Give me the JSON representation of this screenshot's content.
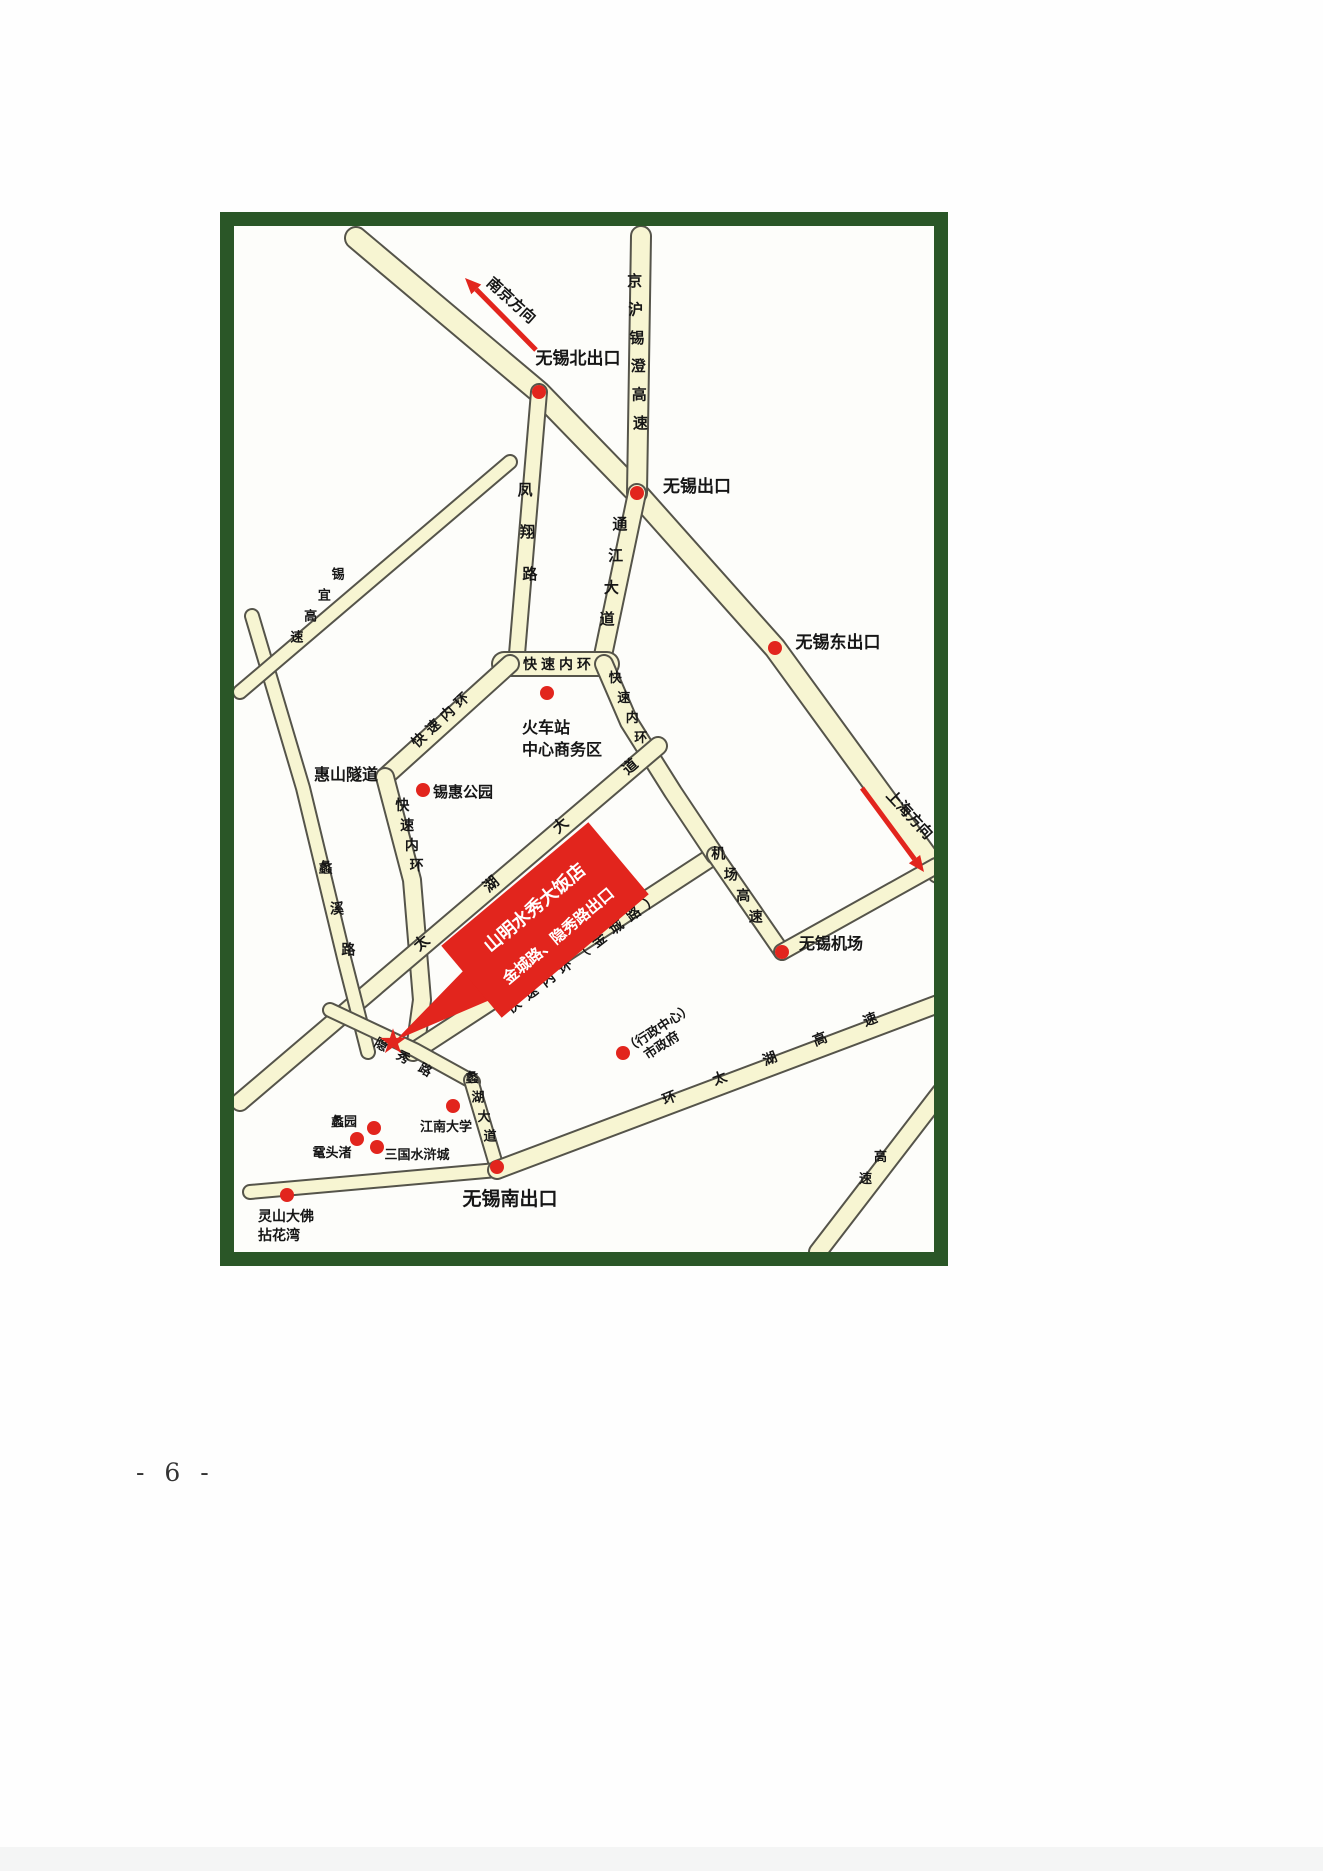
{
  "page": {
    "number_label": "- 6 -"
  },
  "map": {
    "frame_color": "#2a5627",
    "map_bg": "#fdfdfa",
    "road_fill": "#f7f5d2",
    "road_casing": "#55544a",
    "accent_red": "#e2251d",
    "text_color": "#161616",
    "roads": [
      {
        "id": "huning-expressway",
        "points": [
          [
            356,
            238
          ],
          [
            539,
            392
          ],
          [
            637,
            493
          ],
          [
            775,
            648
          ],
          [
            938,
            872
          ]
        ],
        "width": 20
      },
      {
        "id": "jinghu-xicheng-expressway",
        "points": [
          [
            641,
            236
          ],
          [
            637,
            493
          ]
        ],
        "width": 18,
        "label": {
          "text": "京沪锡澄高速",
          "mode": "stacked",
          "from": [
            634,
            272
          ],
          "to": [
            641,
            442
          ],
          "size": 15
        }
      },
      {
        "id": "tongjiang-avenue",
        "points": [
          [
            637,
            493
          ],
          [
            601,
            665
          ]
        ],
        "width": 16,
        "label": {
          "text": "通江大道",
          "mode": "stacked",
          "from": [
            622,
            513
          ],
          "to": [
            605,
            640
          ],
          "size": 15
        }
      },
      {
        "id": "fengxiang-road",
        "points": [
          [
            539,
            392
          ],
          [
            516,
            666
          ]
        ],
        "width": 14,
        "label": {
          "text": "凤翔路",
          "mode": "stacked",
          "from": [
            524,
            474
          ],
          "to": [
            531,
            600
          ],
          "size": 15
        }
      },
      {
        "id": "inner-ring-top",
        "points": [
          [
            504,
            664
          ],
          [
            607,
            664
          ]
        ],
        "width": 22,
        "label": {
          "text": "快速内环",
          "mode": "along",
          "from": [
            521,
            669
          ],
          "to": [
            593,
            669
          ],
          "size": 14
        }
      },
      {
        "id": "inner-ring-northwest",
        "points": [
          [
            510,
            664
          ],
          [
            385,
            777
          ]
        ],
        "width": 16,
        "label": {
          "text": "快速内环",
          "mode": "along",
          "from": [
            415,
            750
          ],
          "to": [
            472,
            697
          ],
          "size": 14
        }
      },
      {
        "id": "inner-ring-west",
        "points": [
          [
            385,
            777
          ],
          [
            412,
            880
          ],
          [
            422,
            1000
          ],
          [
            415,
            1050
          ]
        ],
        "width": 16,
        "label": {
          "text": "快速内环",
          "mode": "stacked",
          "from": [
            400,
            800
          ],
          "to": [
            419,
            880
          ],
          "size": 14
        }
      },
      {
        "id": "inner-ring-south-jincheng-road",
        "points": [
          [
            413,
            1052
          ],
          [
            715,
            855
          ]
        ],
        "width": 16,
        "label": {
          "text": "快速内环（金城路）",
          "mode": "along",
          "from": [
            508,
            1016
          ],
          "to": [
            662,
            898
          ],
          "size": 14
        }
      },
      {
        "id": "inner-ring-east",
        "points": [
          [
            604,
            664
          ],
          [
            629,
            722
          ],
          [
            673,
            792
          ],
          [
            715,
            855
          ]
        ],
        "width": 16,
        "label": {
          "text": "快速内环",
          "mode": "stacked",
          "from": [
            611,
            672
          ],
          "to": [
            645,
            752
          ],
          "size": 13
        }
      },
      {
        "id": "airport-expressway",
        "points": [
          [
            715,
            855
          ],
          [
            782,
            952
          ]
        ],
        "width": 14,
        "label": {
          "text": "机场高速",
          "mode": "stacked",
          "from": [
            712,
            848
          ],
          "to": [
            762,
            932
          ],
          "size": 14
        }
      },
      {
        "id": "airport-link-road",
        "points": [
          [
            782,
            952
          ],
          [
            936,
            866
          ]
        ],
        "width": 14
      },
      {
        "id": "taihu-avenue",
        "points": [
          [
            658,
            746
          ],
          [
            240,
            1102
          ]
        ],
        "width": 16,
        "label": {
          "text": "太湖大道",
          "mode": "along",
          "from": [
            390,
            976
          ],
          "to": [
            668,
            741
          ],
          "size": 15
        }
      },
      {
        "id": "lixi-road",
        "points": [
          [
            252,
            616
          ],
          [
            303,
            788
          ],
          [
            345,
            962
          ],
          [
            368,
            1052
          ]
        ],
        "width": 12,
        "label": {
          "text": "蠡溪路",
          "mode": "stacked",
          "from": [
            320,
            852
          ],
          "to": [
            354,
            975
          ],
          "size": 14
        }
      },
      {
        "id": "xiyi-expressway",
        "points": [
          [
            510,
            462
          ],
          [
            240,
            692
          ]
        ],
        "width": 12,
        "label": {
          "text": "锡宜高速",
          "mode": "stacked",
          "from": [
            345,
            568
          ],
          "to": [
            290,
            652
          ],
          "size": 13
        }
      },
      {
        "id": "yinxiu-road",
        "points": [
          [
            330,
            1010
          ],
          [
            415,
            1050
          ],
          [
            473,
            1082
          ]
        ],
        "width": 12,
        "label": {
          "text": "隐秀路",
          "mode": "along",
          "from": [
            368,
            1042
          ],
          "to": [
            434,
            1080
          ],
          "size": 13
        }
      },
      {
        "id": "lihu-avenue",
        "points": [
          [
            471,
            1080
          ],
          [
            497,
            1168
          ]
        ],
        "width": 12,
        "label": {
          "text": "蠡湖大道",
          "mode": "stacked",
          "from": [
            469,
            1072
          ],
          "to": [
            493,
            1150
          ],
          "size": 13
        }
      },
      {
        "id": "southwest-lakeside-road",
        "points": [
          [
            250,
            1192
          ],
          [
            497,
            1170
          ]
        ],
        "width": 12
      },
      {
        "id": "ring-taihu-expressway",
        "points": [
          [
            497,
            1170
          ],
          [
            938,
            1004
          ]
        ],
        "width": 16,
        "label": {
          "text": "环太湖高速",
          "mode": "along",
          "from": [
            646,
            1112
          ],
          "to": [
            897,
            1014
          ],
          "size": 14
        }
      },
      {
        "id": "corner-expressway",
        "points": [
          [
            941,
            1092
          ],
          [
            818,
            1252
          ]
        ],
        "width": 16,
        "label": {
          "text": "高速",
          "mode": "stacked",
          "from": [
            888,
            1150
          ],
          "to": [
            858,
            1194
          ],
          "size": 13
        }
      }
    ],
    "dots": [
      {
        "id": "wuxi-north-exit-dot",
        "x": 539,
        "y": 392
      },
      {
        "id": "wuxi-exit-dot",
        "x": 637,
        "y": 493
      },
      {
        "id": "wuxi-east-exit-dot",
        "x": 775,
        "y": 648
      },
      {
        "id": "railway-station-dot",
        "x": 547,
        "y": 693
      },
      {
        "id": "xihui-park-dot",
        "x": 423,
        "y": 790
      },
      {
        "id": "wuxi-airport-dot",
        "x": 782,
        "y": 952
      },
      {
        "id": "city-government-dot",
        "x": 623,
        "y": 1053
      },
      {
        "id": "wuxi-south-exit-dot",
        "x": 497,
        "y": 1167
      },
      {
        "id": "jiangnan-university-dot",
        "x": 453,
        "y": 1106
      },
      {
        "id": "liyuan-garden-dot",
        "x": 374,
        "y": 1128
      },
      {
        "id": "yuantouzhu-dot",
        "x": 357,
        "y": 1139
      },
      {
        "id": "three-kingdoms-city-dot",
        "x": 377,
        "y": 1147
      },
      {
        "id": "lingshan-buddha-dot",
        "x": 287,
        "y": 1195
      }
    ],
    "labels": [
      {
        "id": "wuxi-north-exit-label",
        "text": "无锡北出口",
        "x": 578,
        "y": 364,
        "size": 17,
        "bold": true
      },
      {
        "id": "wuxi-exit-label",
        "text": "无锡出口",
        "x": 697,
        "y": 492,
        "size": 17,
        "bold": true
      },
      {
        "id": "wuxi-east-exit-label",
        "text": "无锡东出口",
        "x": 838,
        "y": 648,
        "size": 17,
        "bold": true
      },
      {
        "id": "wuxi-airport-label",
        "text": "无锡机场",
        "x": 831,
        "y": 949,
        "size": 16,
        "bold": true
      },
      {
        "id": "wuxi-south-exit-label",
        "text": "无锡南出口",
        "x": 510,
        "y": 1205,
        "size": 19,
        "bold": true
      },
      {
        "id": "railway-station-label-line1",
        "text": "火车站",
        "x": 522,
        "y": 733,
        "size": 16,
        "bold": true,
        "anchor": "start"
      },
      {
        "id": "railway-station-label-line2",
        "text": "中心商务区",
        "x": 522,
        "y": 755,
        "size": 16,
        "bold": true,
        "anchor": "start"
      },
      {
        "id": "huishan-tunnel-label",
        "text": "惠山隧道",
        "x": 346,
        "y": 780,
        "size": 16,
        "bold": true
      },
      {
        "id": "xihui-park-label",
        "text": "锡惠公园",
        "x": 463,
        "y": 797,
        "size": 15,
        "bold": true
      },
      {
        "id": "jiangnan-university-label",
        "text": "江南大学",
        "x": 446,
        "y": 1131,
        "size": 13,
        "bold": true
      },
      {
        "id": "liyuan-garden-label",
        "text": "蠡园",
        "x": 344,
        "y": 1126,
        "size": 13,
        "bold": true
      },
      {
        "id": "yuantouzhu-label",
        "text": "鼋头渚",
        "x": 332,
        "y": 1157,
        "size": 13,
        "bold": true
      },
      {
        "id": "three-kingdoms-city-label",
        "text": "三国水浒城",
        "x": 417,
        "y": 1159,
        "size": 13,
        "bold": true
      },
      {
        "id": "lingshan-buddha-label-line1",
        "text": "灵山大佛",
        "x": 258,
        "y": 1221,
        "size": 14,
        "bold": true,
        "anchor": "start"
      },
      {
        "id": "lingshan-buddha-label-line2",
        "text": "拈花湾",
        "x": 258,
        "y": 1240,
        "size": 14,
        "bold": true,
        "anchor": "start"
      },
      {
        "id": "admin-center-label",
        "text": "（行政中心）",
        "x": 661,
        "y": 1032,
        "size": 13,
        "bold": true,
        "rotate": -33
      },
      {
        "id": "city-government-label",
        "text": "市政府",
        "x": 664,
        "y": 1049,
        "size": 13,
        "bold": true,
        "rotate": -33
      },
      {
        "id": "nanjing-direction-label",
        "text": "南京方向",
        "x": 508,
        "y": 304,
        "size": 15,
        "bold": true,
        "rotate": 42
      },
      {
        "id": "shanghai-direction-label",
        "text": "上海方向",
        "x": 906,
        "y": 818,
        "size": 15,
        "bold": true,
        "rotate": 47
      }
    ],
    "arrows": [
      {
        "id": "nanjing-direction-arrow",
        "from": [
          536,
          350
        ],
        "to": [
          465,
          278
        ]
      },
      {
        "id": "shanghai-direction-arrow",
        "from": [
          862,
          788
        ],
        "to": [
          924,
          872
        ]
      }
    ],
    "hotel_callout": {
      "id": "hotel-callout",
      "line1": "山明水秀大饭店",
      "line2": "金城路、隐秀路出口",
      "center": [
        545,
        920
      ],
      "width": 192,
      "height": 94,
      "rotate": -40,
      "tail": [
        [
          466,
          968
        ],
        [
          504,
          994
        ],
        [
          396,
          1040
        ]
      ]
    },
    "star": {
      "id": "hotel-star",
      "x": 393,
      "y": 1041,
      "glyph": "★",
      "size": 34
    }
  }
}
